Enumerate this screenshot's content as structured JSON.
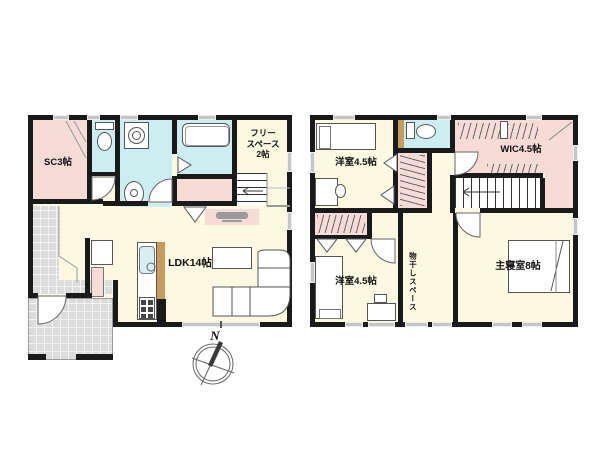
{
  "page": {
    "type": "real-estate floor plan",
    "background": "#ffffff"
  },
  "palette": {
    "wall": "#1a1a1a",
    "room_cream": "#fbf9e1",
    "room_pink": "#f6dbd6",
    "room_wet_blue": "#cdeef1",
    "tile_gray": "#dcdcdc",
    "counter_tan": "#c79a5e",
    "window_gray": "#c6c6c6"
  },
  "floor1": {
    "rooms": {
      "sc": {
        "label": "SC3帖"
      },
      "free": {
        "lines": [
          "フリー",
          "スペース",
          "2帖"
        ]
      },
      "ldk": {
        "label": "LDK14帖"
      }
    }
  },
  "floor2": {
    "rooms": {
      "bedroom_a": {
        "label": "洋室4.5帖"
      },
      "wic": {
        "label": "WIC4.5帖"
      },
      "bedroom_b": {
        "label": "洋室4.5帖"
      },
      "drying": {
        "label": "物干しスペース"
      },
      "master": {
        "label": "主寝室8帖"
      }
    }
  },
  "compass": {
    "north": "N"
  }
}
